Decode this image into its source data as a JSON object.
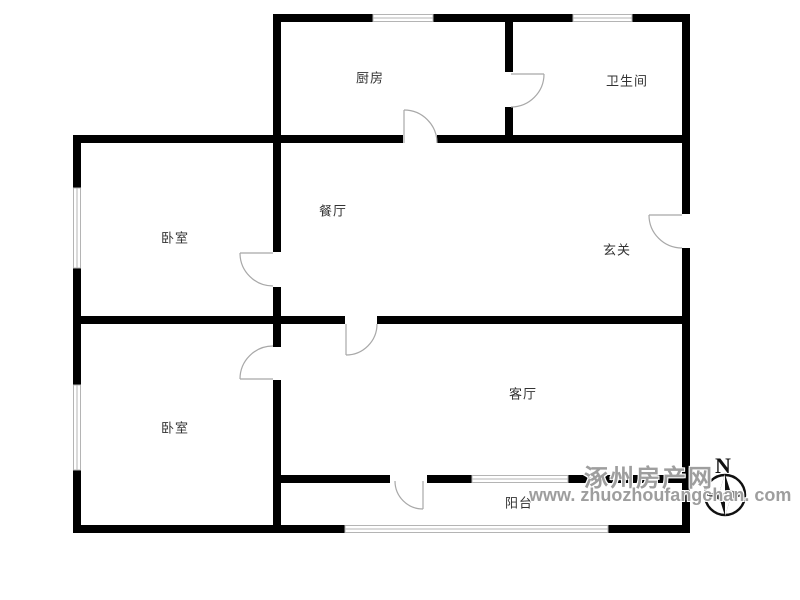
{
  "floorplan": {
    "rooms": {
      "kitchen": {
        "label": "厨房"
      },
      "bathroom": {
        "label": "卫生间"
      },
      "dining_room": {
        "label": "餐厅"
      },
      "entry_hall": {
        "label": "玄关"
      },
      "bedroom_upper": {
        "label": "卧室"
      },
      "bedroom_lower": {
        "label": "卧室"
      },
      "living_room": {
        "label": "客厅"
      },
      "balcony": {
        "label": "阳台"
      }
    },
    "compass": {
      "north_label": "N"
    },
    "watermark": {
      "site_name": "涿州房产网",
      "site_url": "www. zhuozhoufangchan. com"
    },
    "colors": {
      "wall": "#000000",
      "door_line": "#a8a8a8",
      "window_line": "#b4b4b4",
      "room_label": "#333333",
      "watermark_gray": "#9e9e9e"
    }
  }
}
